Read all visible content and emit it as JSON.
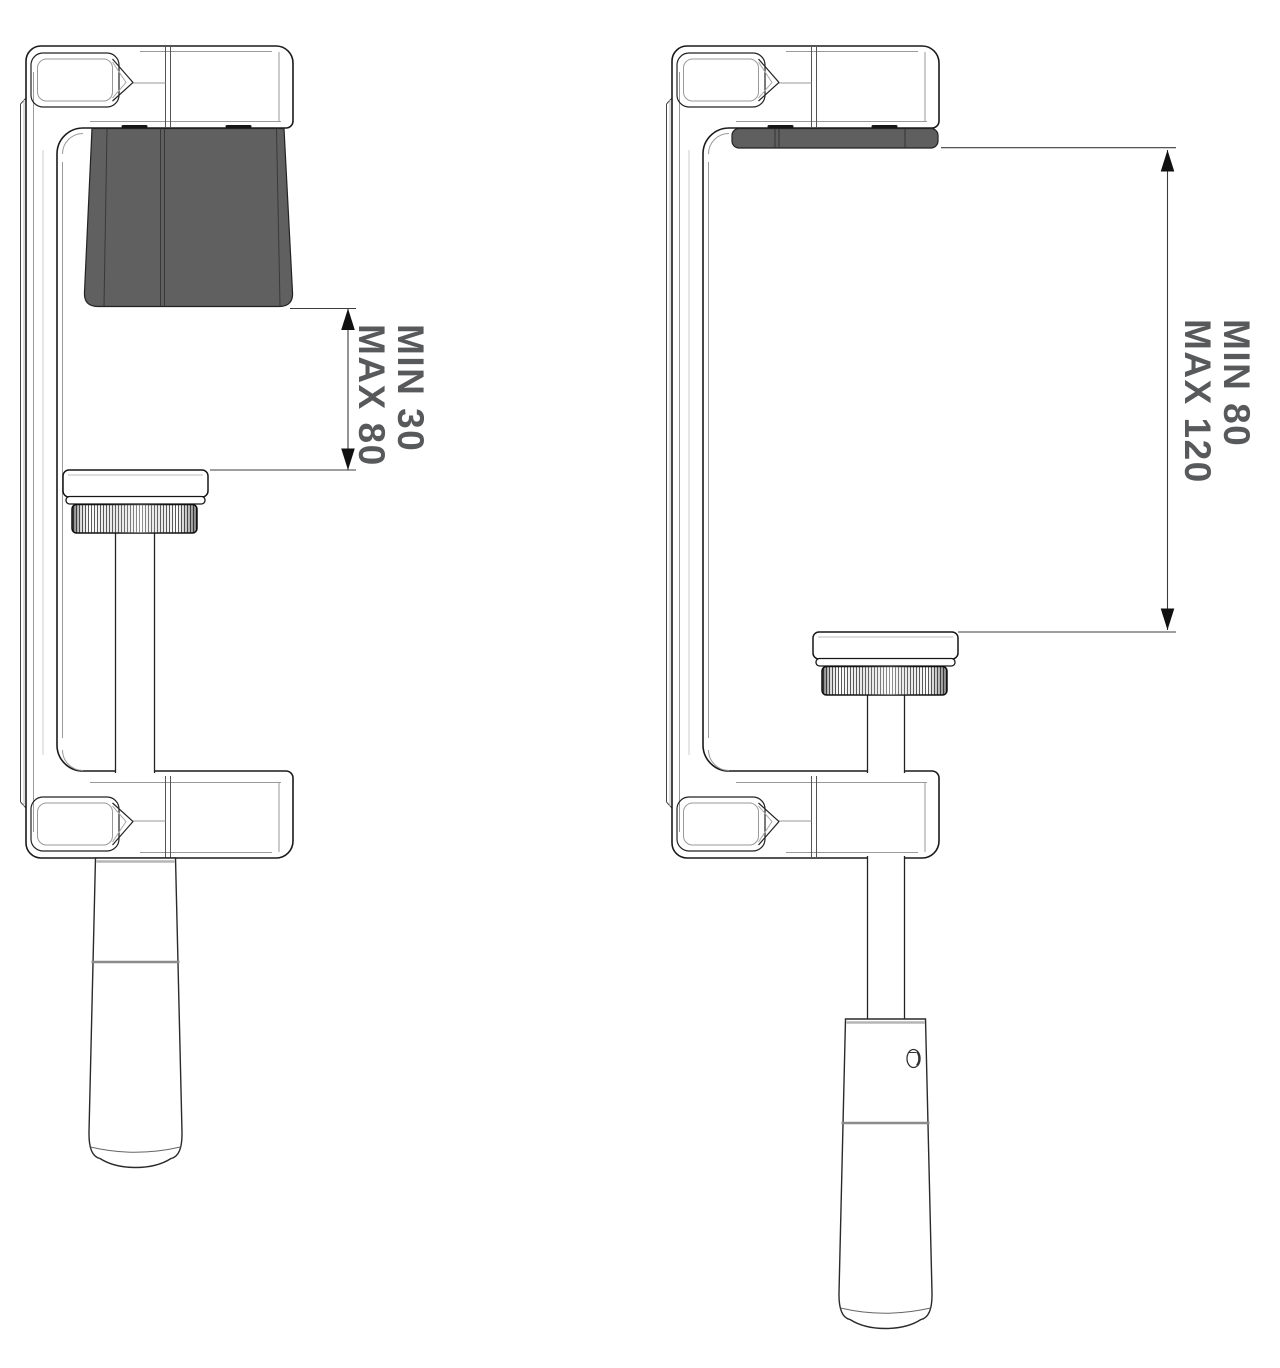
{
  "diagram": {
    "views": {
      "left": {
        "labels": {
          "min": "MIN 30",
          "max": "MAX 80"
        },
        "range": {
          "min": 30,
          "max": 80
        }
      },
      "right": {
        "labels": {
          "min": "MIN 80",
          "max": "MAX 120"
        },
        "range": {
          "min": 80,
          "max": 120
        }
      }
    },
    "colors": {
      "background": "#ffffff",
      "outline": "#1a1a1a",
      "soft_edge": "#9a9a9a",
      "pad_fill": "#606060",
      "dimension_line": "#3c3c3c",
      "dimension_text": "#58595b"
    }
  }
}
